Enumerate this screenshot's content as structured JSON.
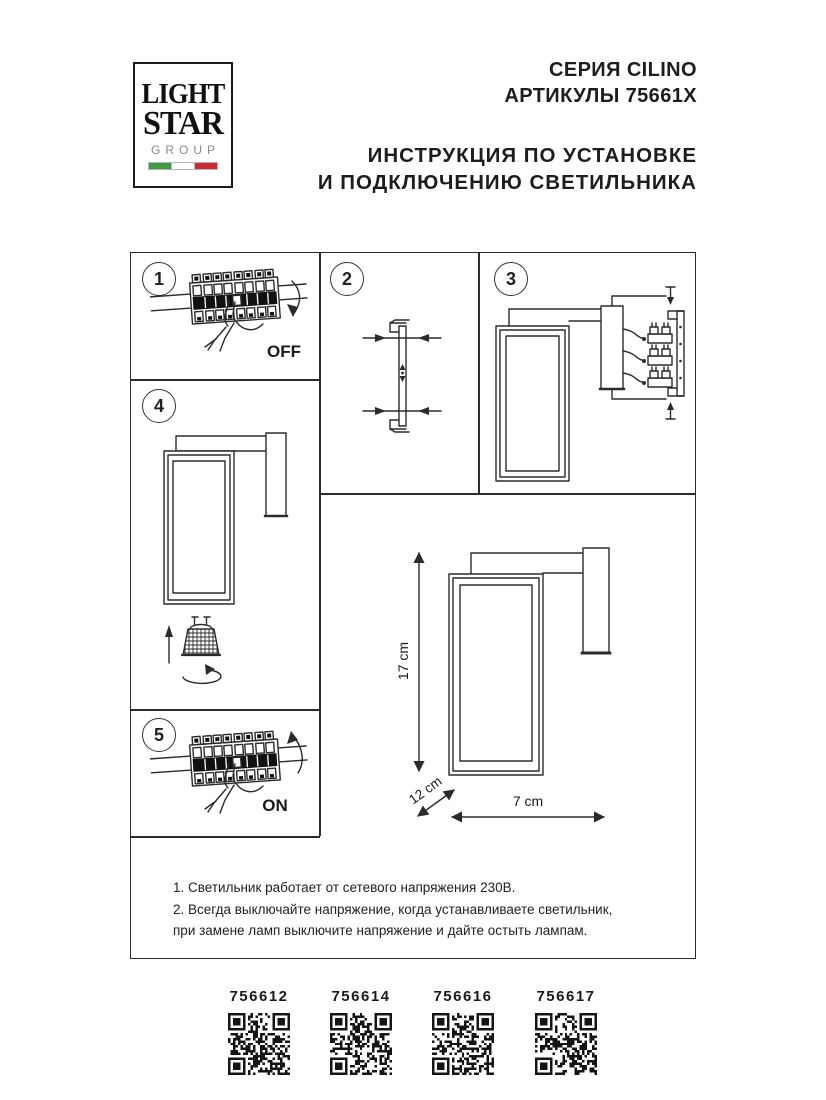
{
  "logo": {
    "word1": "LIGHT",
    "word2": "STAR",
    "word3": "GROUP",
    "flag_green": "#3f9b47",
    "flag_white": "#ffffff",
    "flag_red": "#ce2a33"
  },
  "header": {
    "series": "СЕРИЯ CILINO",
    "articles": "АРТИКУЛЫ 75661X",
    "instruction_line1": "ИНСТРУКЦИЯ ПО УСТАНОВКЕ",
    "instruction_line2": "И ПОДКЛЮЧЕНИЮ СВЕТИЛЬНИКА"
  },
  "steps": {
    "step1": {
      "number": "1",
      "switch_label": "OFF"
    },
    "step2": {
      "number": "2"
    },
    "step3": {
      "number": "3"
    },
    "step4": {
      "number": "4"
    },
    "step5": {
      "number": "5",
      "switch_label": "ON"
    }
  },
  "dimensions": {
    "height": "17 cm",
    "depth": "12 cm",
    "width": "7 cm"
  },
  "notes": {
    "line1": "1. Светильник работает от сетевого напряжения 230В.",
    "line2": "2. Всегда выключайте напряжение, когда устанавливаете светильник,",
    "line3": "при замене ламп выключите напряжение и дайте остыть лампам."
  },
  "qr_codes": [
    {
      "code": "756612"
    },
    {
      "code": "756614"
    },
    {
      "code": "756616"
    },
    {
      "code": "756617"
    }
  ],
  "colors": {
    "line": "#2b2b2b",
    "text": "#1d1d1d"
  }
}
